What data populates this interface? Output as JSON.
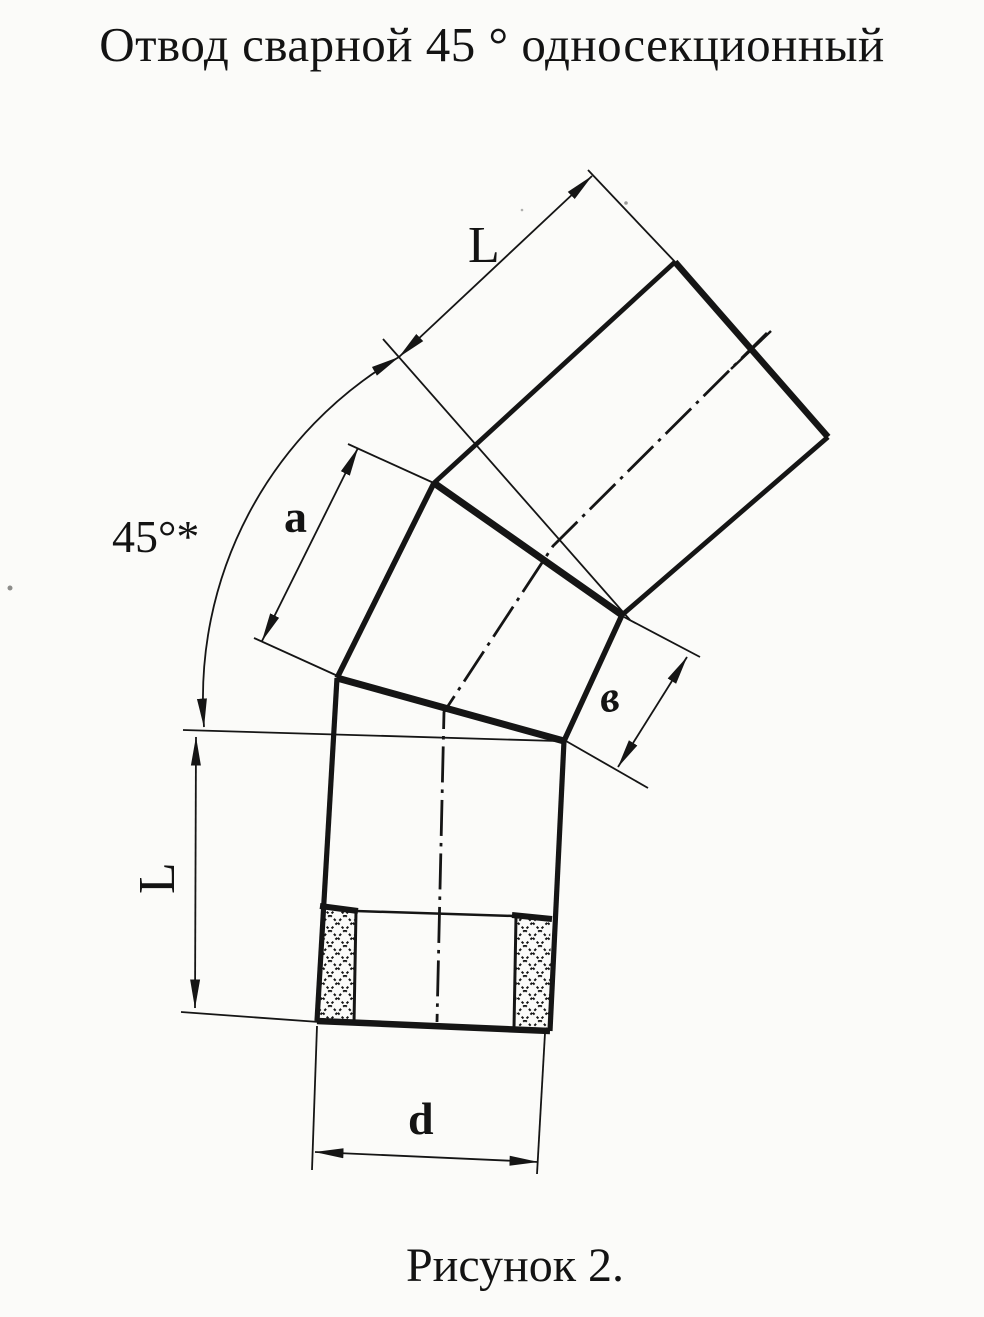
{
  "page": {
    "paper_color": "#fbfbf9",
    "ink_color": "#151515"
  },
  "title": "Отвод сварной 45 ° односекционный",
  "caption": "Рисунок 2.",
  "dimensions": {
    "upper_length": "L",
    "angle": "45°*",
    "outer_segment_side": "a",
    "inner_segment_side": "в",
    "lower_length": "L",
    "diameter": "d"
  }
}
